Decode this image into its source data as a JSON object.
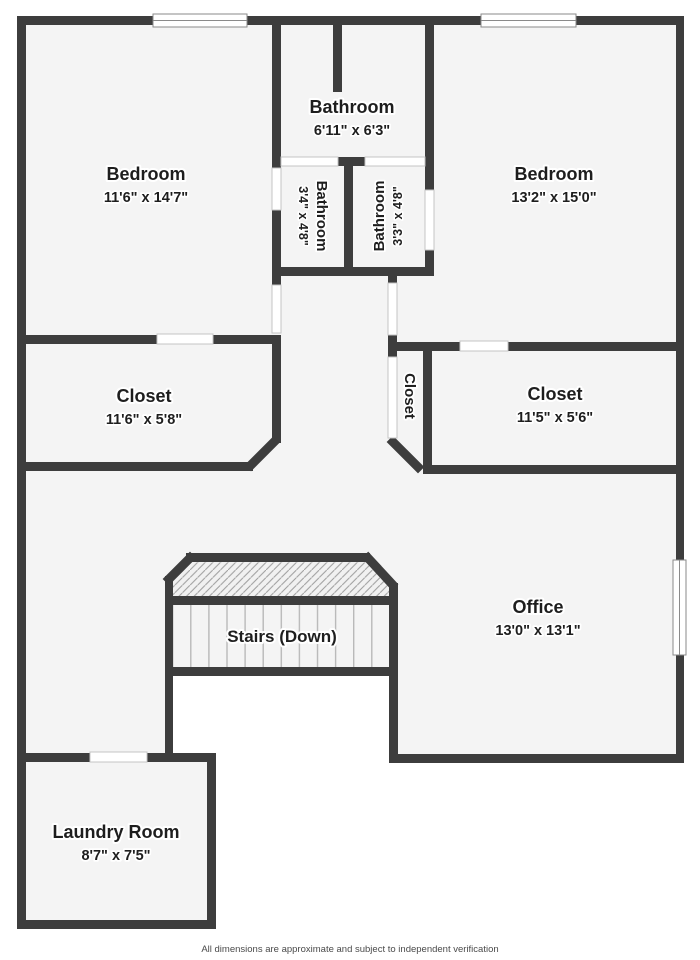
{
  "plan": {
    "rooms": [
      {
        "id": "bedroom-left",
        "name": "Bedroom",
        "dims": "11'6\" x 14'7\""
      },
      {
        "id": "bathroom-top",
        "name": "Bathroom",
        "dims": "6'11\" x 6'3\""
      },
      {
        "id": "bedroom-right",
        "name": "Bedroom",
        "dims": "13'2\" x 15'0\""
      },
      {
        "id": "bathroom-ensuite-left",
        "name": "Bathroom",
        "dims": "3'4\" x 4'8\""
      },
      {
        "id": "bathroom-ensuite-right",
        "name": "Bathroom",
        "dims": "3'3\" x 4'8\""
      },
      {
        "id": "closet-left",
        "name": "Closet",
        "dims": "11'6\" x 5'8\""
      },
      {
        "id": "closet-center",
        "name": "Closet",
        "dims": ""
      },
      {
        "id": "closet-right",
        "name": "Closet",
        "dims": "11'5\" x 5'6\""
      },
      {
        "id": "stairs",
        "name": "Stairs (Down)",
        "dims": ""
      },
      {
        "id": "office",
        "name": "Office",
        "dims": "13'0\" x 13'1\""
      },
      {
        "id": "laundry-room",
        "name": "Laundry Room",
        "dims": "8'7\" x 7'5\""
      }
    ],
    "footer": "All dimensions are approximate and subject to independent verification",
    "colors": {
      "wall": "#3d3d3d",
      "floor": "#f4f4f4",
      "background": "#ffffff",
      "hatch_line": "#9c9c9c",
      "tread_line": "#b9b9b9",
      "text": "#1e1e1e"
    }
  }
}
